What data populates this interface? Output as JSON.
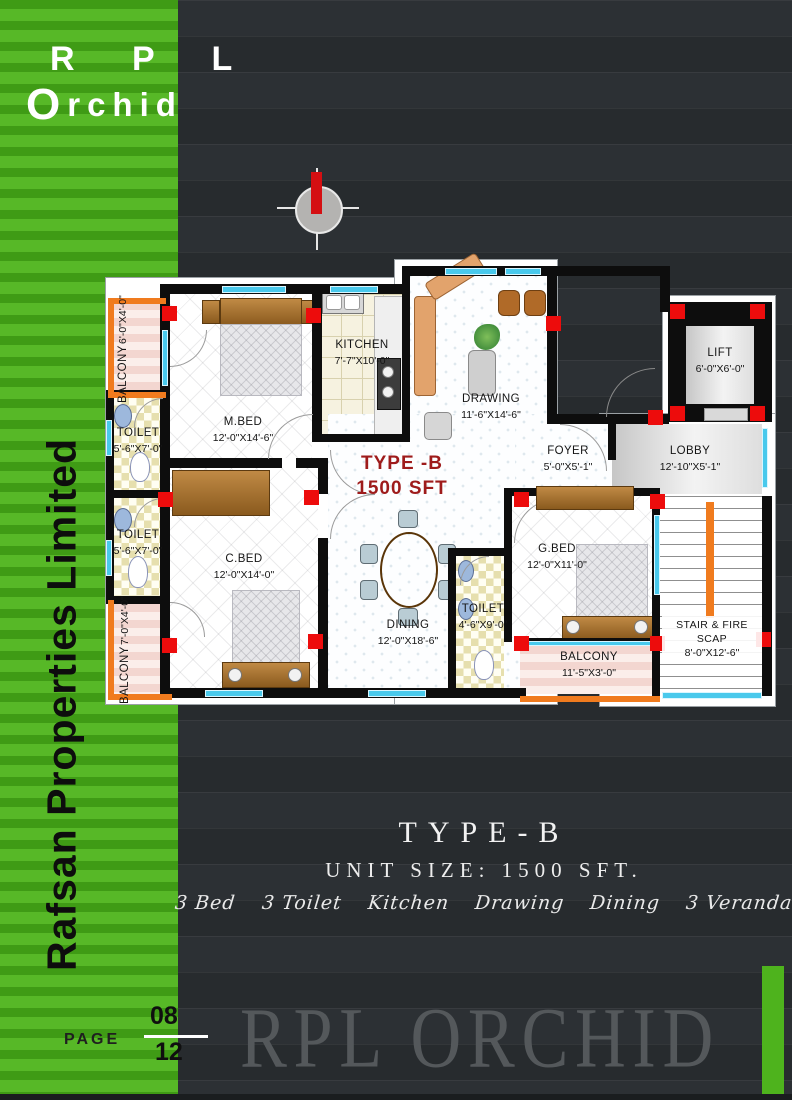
{
  "brand": {
    "logo_line1": "R P L",
    "logo_line2_initial": "O",
    "logo_line2_rest": "rchid",
    "sidebar_text": "Rafsan Properties Limited",
    "watermark": "RPL ORCHID"
  },
  "page": {
    "label": "PAGE",
    "number": "08",
    "total": "12"
  },
  "plan": {
    "type_label": "TYPE -B",
    "size_label": "1500 SFT",
    "rooms": {
      "balcony_tl": {
        "name": "BALCONY",
        "dims": "6'-0\"X4'-0\""
      },
      "toilet_1": {
        "name": "TOILET",
        "dims": "5'-6\"X7'-0\""
      },
      "toilet_2": {
        "name": "TOILET",
        "dims": "5'-6\"X7'-0\""
      },
      "balcony_bl": {
        "name": "BALCONY",
        "dims": "7'-0\"X4'-0\""
      },
      "mbed": {
        "name": "M.BED",
        "dims": "12'-0\"X14'-6\""
      },
      "kitchen": {
        "name": "KITCHEN",
        "dims": "7'-7\"X10'-0\""
      },
      "drawing": {
        "name": "DRAWING",
        "dims": "11'-6\"X14'-6\""
      },
      "cbed": {
        "name": "C.BED",
        "dims": "12'-0\"X14'-0\""
      },
      "dining": {
        "name": "DINING",
        "dims": "12'-0\"X18'-6\""
      },
      "foyer": {
        "name": "FOYER",
        "dims": "5'-0\"X5'-1\""
      },
      "lobby": {
        "name": "LOBBY",
        "dims": "12'-10\"X5'-1\""
      },
      "lift": {
        "name": "LIFT",
        "dims": "6'-0\"X6'-0\""
      },
      "gbed": {
        "name": "G.BED",
        "dims": "12'-0\"X11'-0\""
      },
      "toilet_3": {
        "name": "TOILET",
        "dims": "4'-6\"X9'-0\""
      },
      "balcony_br": {
        "name": "BALCONY",
        "dims": "11'-5\"X3'-0\""
      },
      "stair": {
        "name": "STAIR & FIRE SCAP",
        "dims": "8'-0\"X12'-6\""
      }
    }
  },
  "summary": {
    "title": "TYPE-B",
    "subtitle": "UNIT SIZE: 1500 SFT.",
    "features": [
      "3  Bed",
      "3  Toilet",
      "Kitchen",
      "Drawing",
      "Dining",
      "3  Veranda"
    ]
  },
  "colors": {
    "accent_green": "#4eb31d",
    "dark_background": "#292d30",
    "wall_black": "#0d0d0d",
    "column_red": "#ed0c0c",
    "window_cyan": "#49c9ec",
    "balcony_orange": "#f07b1e",
    "plan_type_red": "#9e1b1b"
  }
}
